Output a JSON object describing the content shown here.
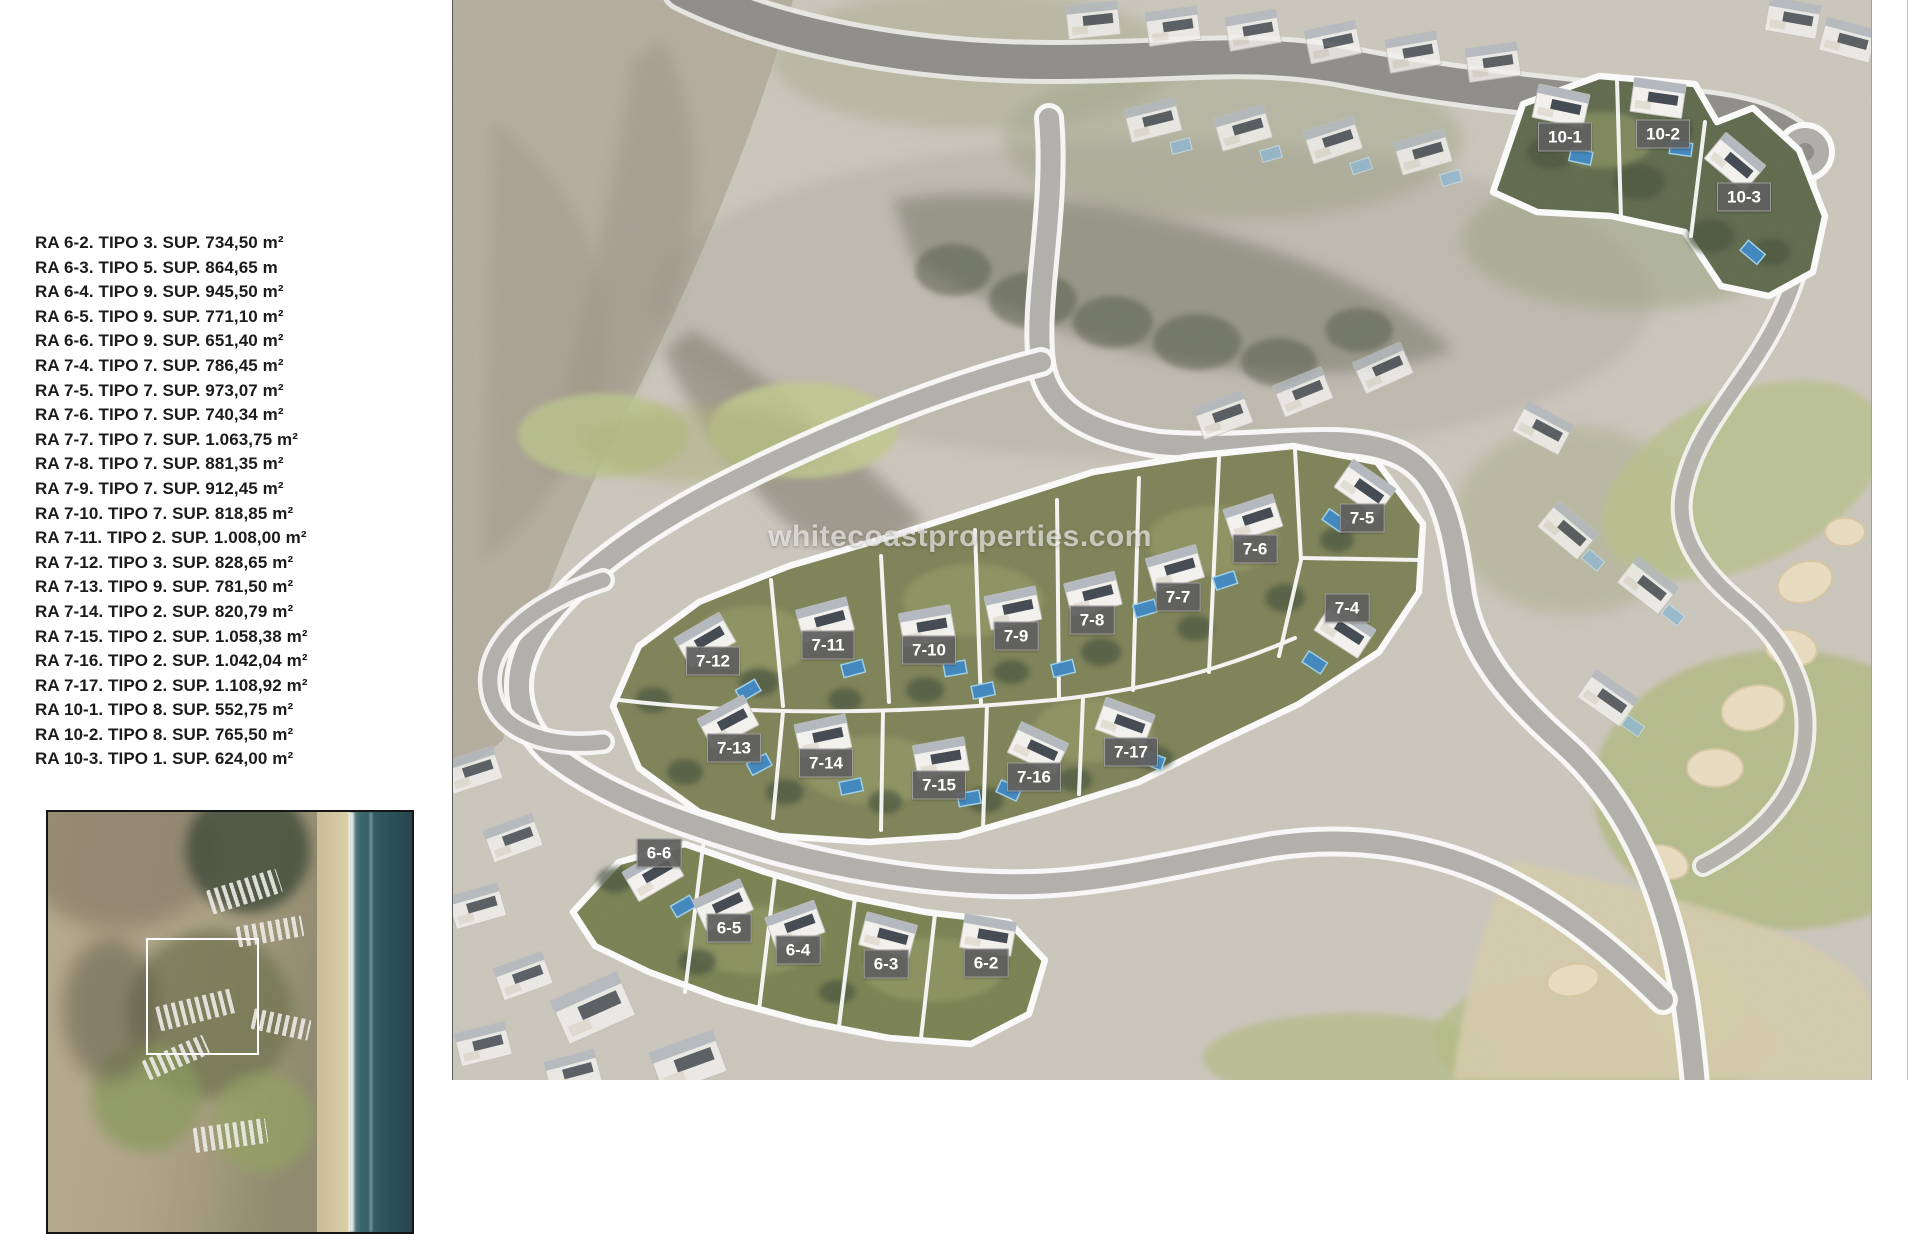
{
  "legend": {
    "items": [
      {
        "ra": "RA 6-2",
        "tipo": "TIPO 3",
        "sup": "SUP. 734,50 m²"
      },
      {
        "ra": "RA 6-3",
        "tipo": "TIPO 5",
        "sup": "SUP. 864,65 m"
      },
      {
        "ra": "RA 6-4",
        "tipo": "TIPO 9",
        "sup": "SUP. 945,50 m²"
      },
      {
        "ra": "RA 6-5",
        "tipo": "TIPO 9",
        "sup": "SUP. 771,10 m²"
      },
      {
        "ra": "RA 6-6",
        "tipo": "TIPO 9",
        "sup": "SUP. 651,40 m²"
      },
      {
        "ra": "RA 7-4",
        "tipo": "TIPO 7",
        "sup": "SUP. 786,45 m²"
      },
      {
        "ra": "RA 7-5",
        "tipo": "TIPO 7",
        "sup": "SUP. 973,07 m²"
      },
      {
        "ra": "RA 7-6",
        "tipo": "TIPO 7",
        "sup": "SUP. 740,34 m²"
      },
      {
        "ra": "RA 7-7",
        "tipo": "TIPO 7",
        "sup": "SUP. 1.063,75 m²"
      },
      {
        "ra": "RA 7-8",
        "tipo": "TIPO 7",
        "sup": "SUP. 881,35 m²"
      },
      {
        "ra": "RA 7-9",
        "tipo": "TIPO 7",
        "sup": "SUP. 912,45 m²"
      },
      {
        "ra": "RA 7-10",
        "tipo": "TIPO 7",
        "sup": "SUP. 818,85 m²"
      },
      {
        "ra": "RA 7-11",
        "tipo": "TIPO 2",
        "sup": "SUP. 1.008,00 m²"
      },
      {
        "ra": "RA 7-12",
        "tipo": "TIPO 3",
        "sup": "SUP. 828,65 m²"
      },
      {
        "ra": "RA 7-13",
        "tipo": "TIPO 9",
        "sup": "SUP. 781,50 m²"
      },
      {
        "ra": "RA 7-14",
        "tipo": "TIPO 2",
        "sup": "SUP. 820,79 m²"
      },
      {
        "ra": "RA 7-15",
        "tipo": "TIPO 2",
        "sup": "SUP. 1.058,38 m²"
      },
      {
        "ra": "RA 7-16",
        "tipo": "TIPO 2",
        "sup": "SUP. 1.042,04 m²"
      },
      {
        "ra": "RA 7-17",
        "tipo": "TIPO 2",
        "sup": "SUP. 1.108,92 m²"
      },
      {
        "ra": "RA 10-1",
        "tipo": "TIPO 8",
        "sup": "SUP. 552,75 m²"
      },
      {
        "ra": "RA 10-2",
        "tipo": "TIPO 8",
        "sup": "SUP. 765,50 m²"
      },
      {
        "ra": "RA 10-3",
        "tipo": "TIPO 1",
        "sup": "SUP. 624,00 m²"
      }
    ]
  },
  "map": {
    "watermark": "whitecoastproperties.com",
    "plots": [
      {
        "id": "10-1",
        "x": 1112,
        "y": 137
      },
      {
        "id": "10-2",
        "x": 1210,
        "y": 134
      },
      {
        "id": "10-3",
        "x": 1291,
        "y": 197
      },
      {
        "id": "7-5",
        "x": 909,
        "y": 518
      },
      {
        "id": "7-6",
        "x": 802,
        "y": 549
      },
      {
        "id": "7-7",
        "x": 725,
        "y": 597
      },
      {
        "id": "7-4",
        "x": 894,
        "y": 608
      },
      {
        "id": "7-8",
        "x": 639,
        "y": 620
      },
      {
        "id": "7-9",
        "x": 563,
        "y": 636
      },
      {
        "id": "7-11",
        "x": 375,
        "y": 645
      },
      {
        "id": "7-10",
        "x": 476,
        "y": 650
      },
      {
        "id": "7-12",
        "x": 260,
        "y": 661
      },
      {
        "id": "7-13",
        "x": 281,
        "y": 748
      },
      {
        "id": "7-17",
        "x": 678,
        "y": 752
      },
      {
        "id": "7-14",
        "x": 373,
        "y": 763
      },
      {
        "id": "7-16",
        "x": 581,
        "y": 777
      },
      {
        "id": "7-15",
        "x": 486,
        "y": 785
      },
      {
        "id": "6-6",
        "x": 206,
        "y": 853
      },
      {
        "id": "6-5",
        "x": 276,
        "y": 928
      },
      {
        "id": "6-4",
        "x": 345,
        "y": 950
      },
      {
        "id": "6-3",
        "x": 433,
        "y": 964
      },
      {
        "id": "6-2",
        "x": 533,
        "y": 963
      }
    ]
  },
  "colors": {
    "plot_label_bg": "#5f5f5f",
    "plot_label_text": "#ffffff",
    "boundary": "#ffffff",
    "cluster_green": "#7d8155",
    "dark_trees": "#47523a",
    "pool_blue": "#3c86c0",
    "road_gray": "#b3b1ab",
    "dark_road": "#8e8d88",
    "sand": "#d8cead",
    "golf_green": "#b9c28b",
    "ocean": "#2e545e",
    "legend_text": "#1b1b1b"
  }
}
